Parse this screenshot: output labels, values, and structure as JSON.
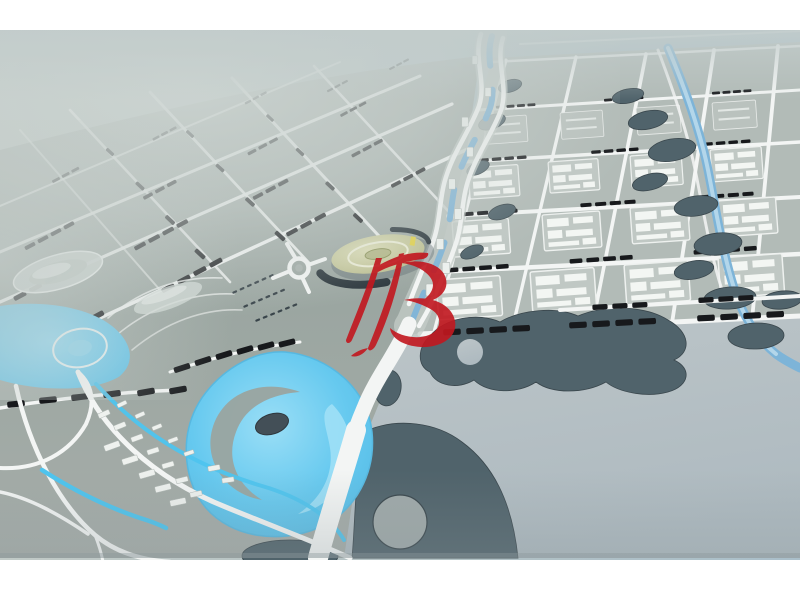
{
  "image": {
    "description": "Oblique aerial photograph of an architectural city master-plan scale model with grid blocks, winding river corridor, cyan lagoon with swirl island, dark parkland shapes and a red calligraphic watermark",
    "type": "photograph"
  },
  "frame": {
    "top_band_px": 30,
    "bottom_band_px": 40
  },
  "palette": {
    "frame": "#ffffff",
    "background_left": "#c1cac7",
    "background_mid": "#b4c2c4",
    "background_right": "#aabfca",
    "haze": "#ccd4d1",
    "ground": "#9ba6a1",
    "ground_dark": "#8f9a96",
    "block_fill": "#b2bbb7",
    "road": "#f3f5f4",
    "building_bar": "#17191c",
    "compound_white": "#f3f6f3",
    "water_lagoon": "#66c9ef",
    "water_lagoon_light": "#9adef6",
    "water_river": "#7db4d8",
    "water_canal": "#4ec4ee",
    "park_blob": "#50636b",
    "park_blob_edge": "#3a474d",
    "baseboard": "#b7c0c4",
    "plaza_fill": "#c9cba0",
    "plaza_dark": "#2c373d",
    "plaza_accent": "#e2d24a",
    "island_dark": "#434f57",
    "watermark_red": "#c2171f"
  },
  "watermark": {
    "label": "red calligraphic brush monogram",
    "opacity": 0.9
  }
}
